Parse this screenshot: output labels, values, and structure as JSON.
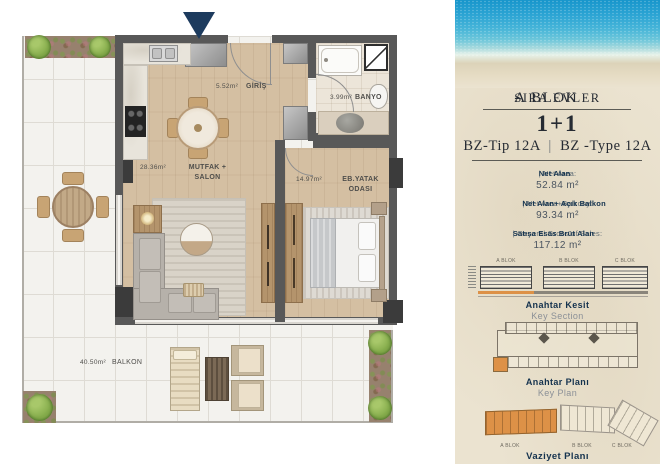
{
  "floorplan": {
    "rooms": [
      {
        "name": "GİRİŞ",
        "area": "5.52m²"
      },
      {
        "name": "BANYO",
        "area": "3.99m²"
      },
      {
        "name": "MUTFAK + SALON",
        "area": "28.36m²"
      },
      {
        "name": "EB.YATAK ODASI",
        "area": "14.97m²"
      },
      {
        "name": "BALKON",
        "area": "40.50m²"
      }
    ]
  },
  "panel": {
    "title": {
      "left": "A BLOK",
      "sep": "-",
      "right": "SIRA EVLER"
    },
    "unit_type": "1+1",
    "type_code": {
      "tr": "BZ-Tip 12A",
      "sep": "|",
      "en": "BZ -Type 12A"
    },
    "areas": [
      {
        "label_tr": "Net Alan",
        "label_en": "| Net Area:",
        "value": "52.84 m²"
      },
      {
        "label_tr": "Net Alan+ Açık Balkon",
        "label_en": "| Net Area+Balcony:",
        "value": "93.34 m²"
      },
      {
        "label_tr": "Satışa Esas Brüt Alan",
        "label_en": "| General Groos of Sales:",
        "value": "117.12 m²"
      }
    ],
    "key_section": {
      "title_tr": "Anahtar Kesit",
      "title_en": "Key Section",
      "blocks": [
        "A BLOK",
        "B BLOK",
        "C BLOK"
      ]
    },
    "key_plan": {
      "title_tr": "Anahtar Planı",
      "title_en": "Key Plan"
    },
    "site_plan": {
      "title_tr": "Vaziyet Planı",
      "blocks": [
        "A BLOK",
        "B BLOK",
        "C BLOK"
      ]
    },
    "colors": {
      "accent_orange": "#dd9147",
      "navy": "#1d3b5e",
      "wall_gray": "#585858",
      "wood_floor": "#d4bfa2",
      "sea_blue": "#2aa3d3"
    }
  }
}
